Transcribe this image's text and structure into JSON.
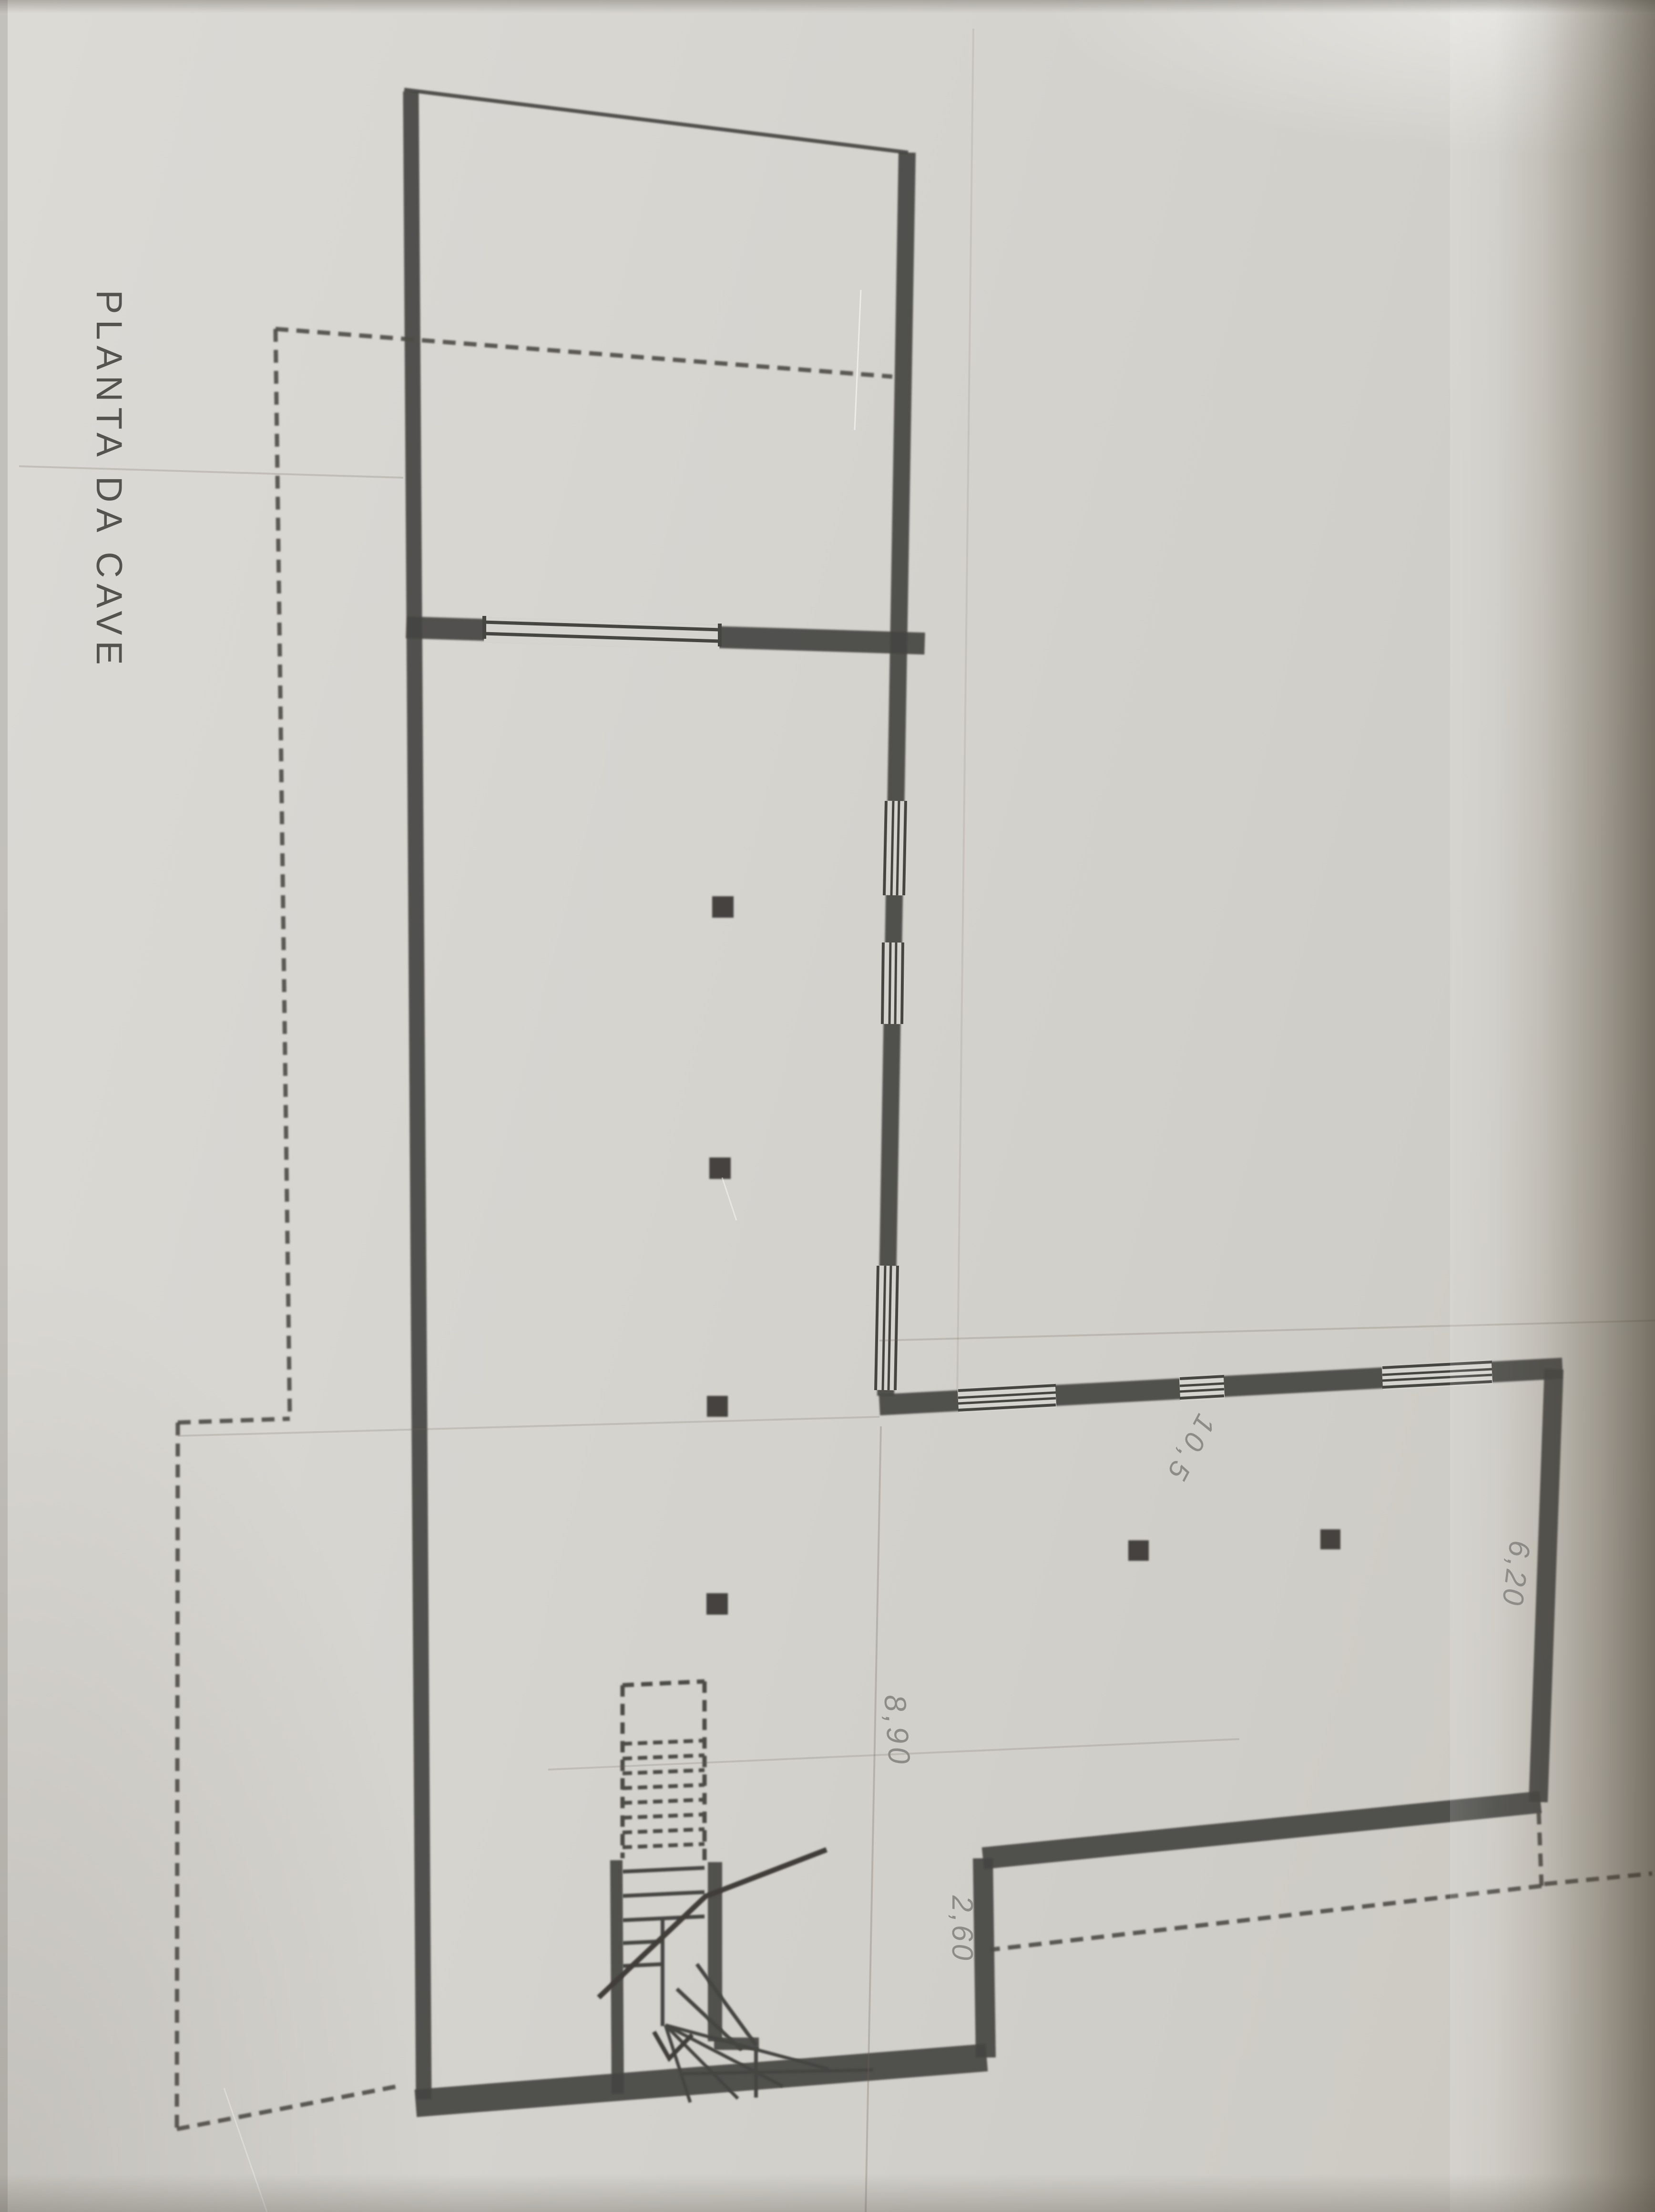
{
  "page": {
    "kind": "scanned basement floor plan drawing",
    "title": "PLANTA DA CAVE"
  },
  "dimensions": {
    "d1": "8,90",
    "d2": "2,60",
    "d3": "10,5",
    "d4": "6,20"
  },
  "colors": {
    "paper": "#d6d4cf",
    "ink": "#454542",
    "pencil": "#8d8c88",
    "edge_shadow": "#40382a"
  }
}
